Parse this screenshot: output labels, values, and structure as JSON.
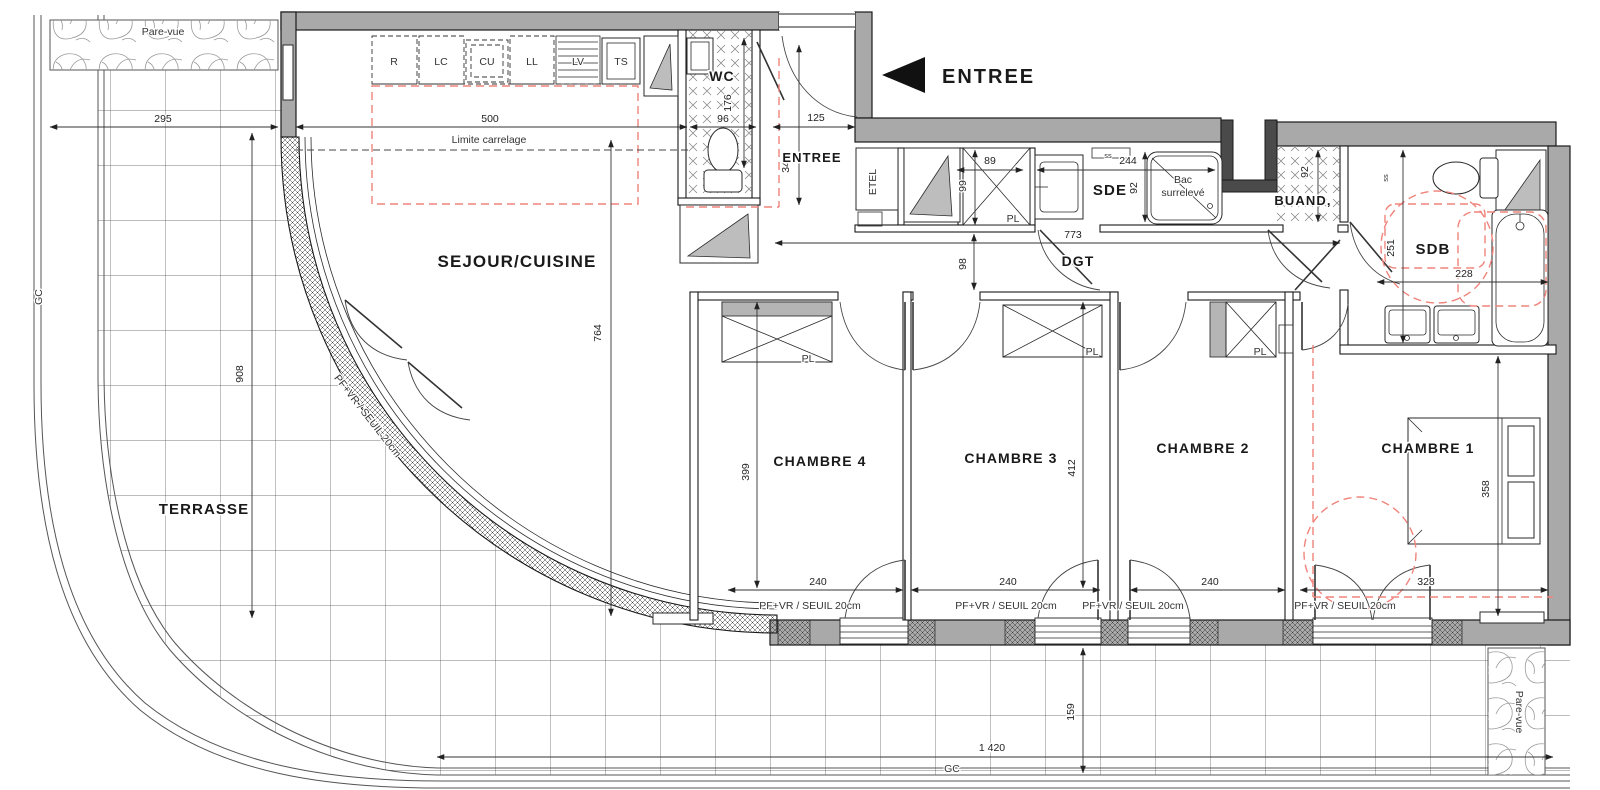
{
  "colors": {
    "wall": "#a9a9a9",
    "line": "#1a1a1a",
    "red_dashed": "#f0837b",
    "grid": "#4d4d4d"
  },
  "rooms": {
    "sejour": "SEJOUR/CUISINE",
    "terrasse": "TERRASSE",
    "wc": "WC",
    "entree": "ENTREE",
    "sde": "SDE",
    "dgt": "DGT",
    "buand": "BUAND,",
    "sdb": "SDB",
    "ch1": "CHAMBRE 1",
    "ch2": "CHAMBRE 2",
    "ch3": "CHAMBRE 3",
    "ch4": "CHAMBRE 4"
  },
  "entry": {
    "arrow_label": "ENTREE"
  },
  "kitchen": {
    "units": [
      "R",
      "LC",
      "CU",
      "LL",
      "LV",
      "TS"
    ]
  },
  "fixtures": {
    "bac1": "Bac",
    "bac2": "surrelevé",
    "etel": "ETEL",
    "closet": "PL",
    "ss": "ss"
  },
  "annotations": {
    "pare_vue": "Pare-vue",
    "limite": "Limite carrelage",
    "sill": "PF+VR / SEUIL 20cm",
    "gc": "GC"
  },
  "dims": {
    "terrasse_w": "295",
    "sejour_w": "500",
    "wc_w": "96",
    "wc_d": "176",
    "entree_w": "125",
    "entree_d": "345",
    "pl_w": "89",
    "pl_d": "99",
    "sde_w": "244",
    "sde_d": "92",
    "buand_d": "92",
    "dgt_l": "773",
    "dgt_w": "98",
    "sejour_d": "764",
    "terrasse_d": "908",
    "sdb_d": "251",
    "sdb_w": "228",
    "ch4_d": "399",
    "ch4_w": "240",
    "ch3_d": "412",
    "ch3_w": "240",
    "ch2_w": "240",
    "ch1_w": "328",
    "ch1_d": "358",
    "terr_s_w": "1 420",
    "terr_s_d": "159"
  }
}
